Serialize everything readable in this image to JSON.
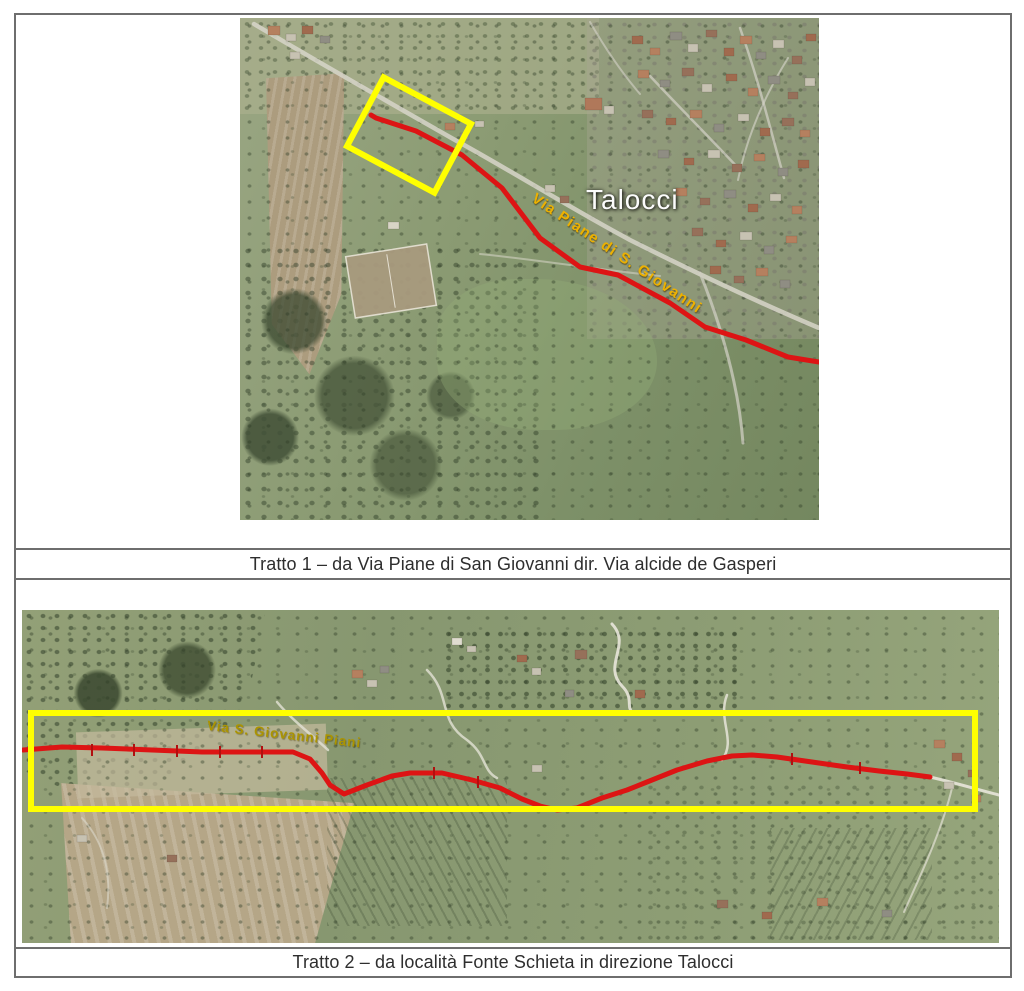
{
  "page": {
    "background": "#ffffff",
    "table_border_color": "#6e6e6e"
  },
  "colors": {
    "highlight_yellow": "#ffff00",
    "route_red": "#dd1414"
  },
  "figure1": {
    "caption": "Tratto 1 – da Via Piane di San Giovanni dir. Via alcide de Gasperi",
    "map": {
      "kind": "aerial-photo",
      "town_label": "Talocci",
      "road_label": "Via Piane di S. Giovanni"
    }
  },
  "figure2": {
    "caption": "Tratto 2 – da località Fonte Schieta in direzione Talocci",
    "map": {
      "kind": "aerial-photo",
      "road_label": "Via S. Giovanni Piani"
    }
  }
}
